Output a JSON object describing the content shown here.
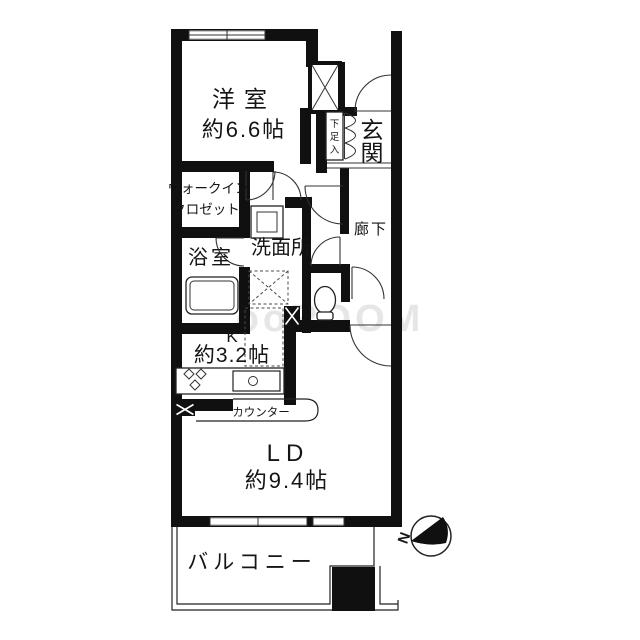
{
  "watermark": "ooROOM",
  "compass": {
    "north_label": "N"
  },
  "rooms": {
    "western_room": {
      "name": "洋室",
      "size": "約6.6帖"
    },
    "walk_in_closet": {
      "line1": "ウォークイン",
      "line2": "クロゼット"
    },
    "bathroom": {
      "name": "浴室"
    },
    "washroom": {
      "name": "洗面所"
    },
    "entrance": {
      "name": "玄関",
      "chars": [
        "玄",
        "関"
      ]
    },
    "shoe_closet": {
      "name": "下足入",
      "chars": [
        "下",
        "足",
        "入"
      ]
    },
    "hallway": {
      "name": "廊下"
    },
    "kitchen": {
      "label": "K",
      "size": "約3.2帖"
    },
    "counter": {
      "name": "カウンター"
    },
    "living_dining": {
      "label": "LD",
      "size": "約9.4帖"
    },
    "balcony": {
      "name": "バルコニー"
    }
  },
  "colors": {
    "wall": "#101010",
    "line": "#333333",
    "watermark": "#d6d6d6"
  }
}
